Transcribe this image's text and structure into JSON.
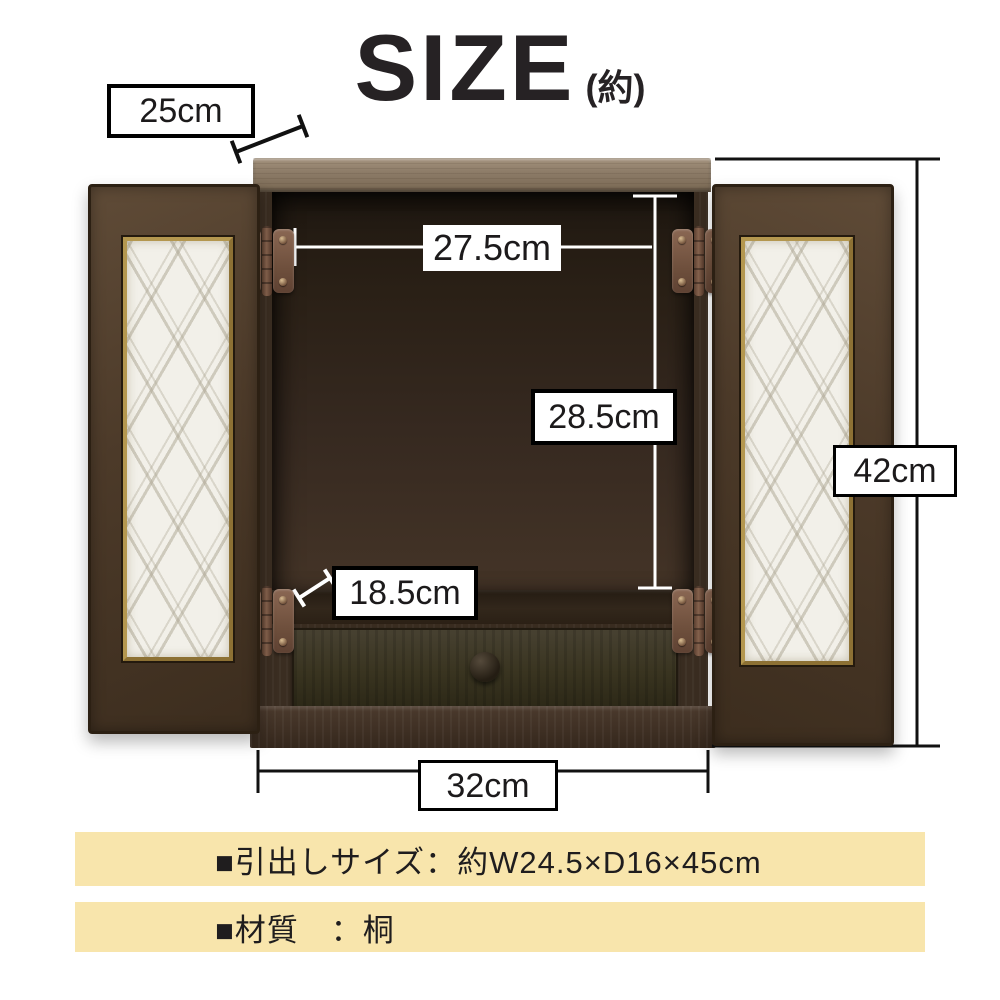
{
  "title": {
    "main": "SIZE",
    "suffix": "(約)"
  },
  "diagram": {
    "type": "product-size-diagram",
    "product": "wooden altar cabinet with two glass-panel doors and drawer",
    "dimensions": {
      "top_depth": {
        "label": "25cm",
        "meaning": "depth of top board (diagonal indicator)"
      },
      "inner_width": {
        "label": "27.5cm",
        "meaning": "interior width"
      },
      "inner_height": {
        "label": "28.5cm",
        "meaning": "interior height"
      },
      "shelf_depth": {
        "label": "18.5cm",
        "meaning": "interior floor depth (diagonal indicator)"
      },
      "total_height": {
        "label": "42cm",
        "meaning": "overall height"
      },
      "total_width": {
        "label": "32cm",
        "meaning": "overall width"
      }
    }
  },
  "specs": [
    {
      "text": "■引出しサイズ：約W24.5×D16×45cm"
    },
    {
      "text": "■材質　：桐"
    }
  ],
  "colors": {
    "spec_bar_bg": "#f8e5ac",
    "wood_dark": "#3a2d21",
    "wood_top_board": "#8b7a66",
    "hinge": "#7a5a46",
    "dimension_line_black": "#000000",
    "dimension_line_white": "#ffffff"
  }
}
